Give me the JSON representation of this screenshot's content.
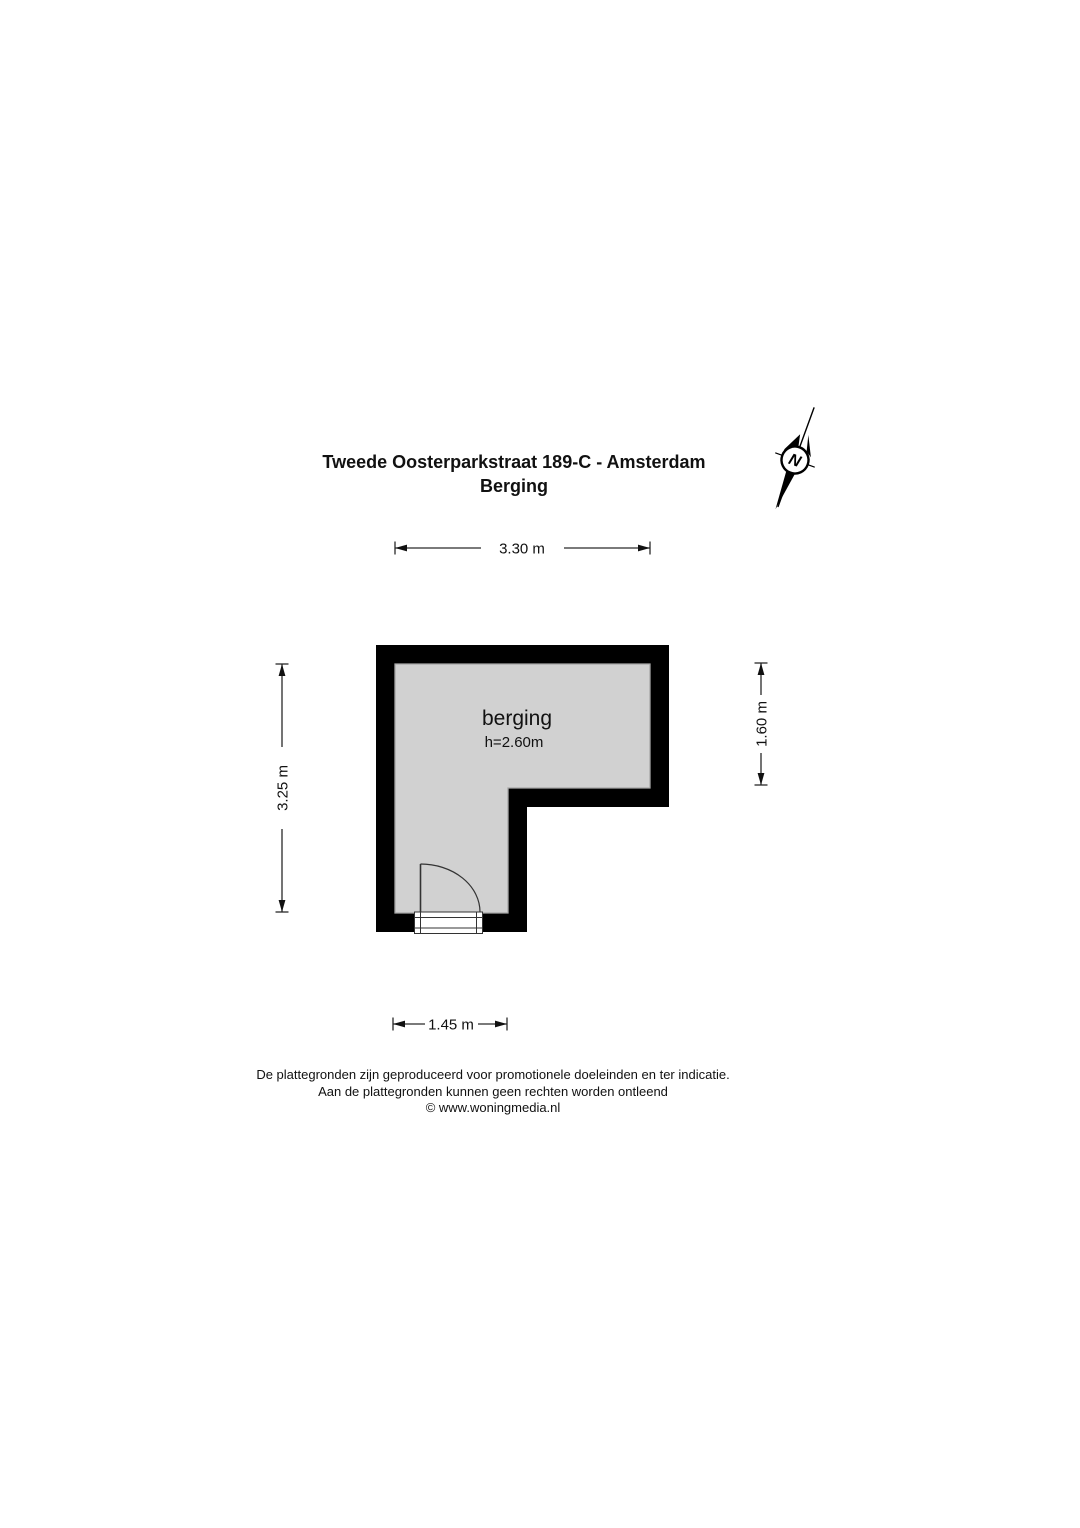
{
  "title": {
    "address": "Tweede Oosterparkstraat 189-C - Amsterdam",
    "subtitle": "Berging"
  },
  "compass": {
    "label": "N"
  },
  "room": {
    "name": "berging",
    "ceiling_height": "h=2.60m",
    "fill_color": "#d1d1d1",
    "wall_color": "#000000"
  },
  "dimensions": {
    "top_width": "3.30 m",
    "left_height": "3.25 m",
    "right_height": "1.60 m",
    "bottom_width": "1.45 m"
  },
  "footer": {
    "line1": "De plattegronden zijn geproduceerd voor promotionele doeleinden en ter indicatie.",
    "line2": "Aan de plattegronden kunnen geen rechten worden ontleend",
    "line3": "© www.woningmedia.nl"
  }
}
